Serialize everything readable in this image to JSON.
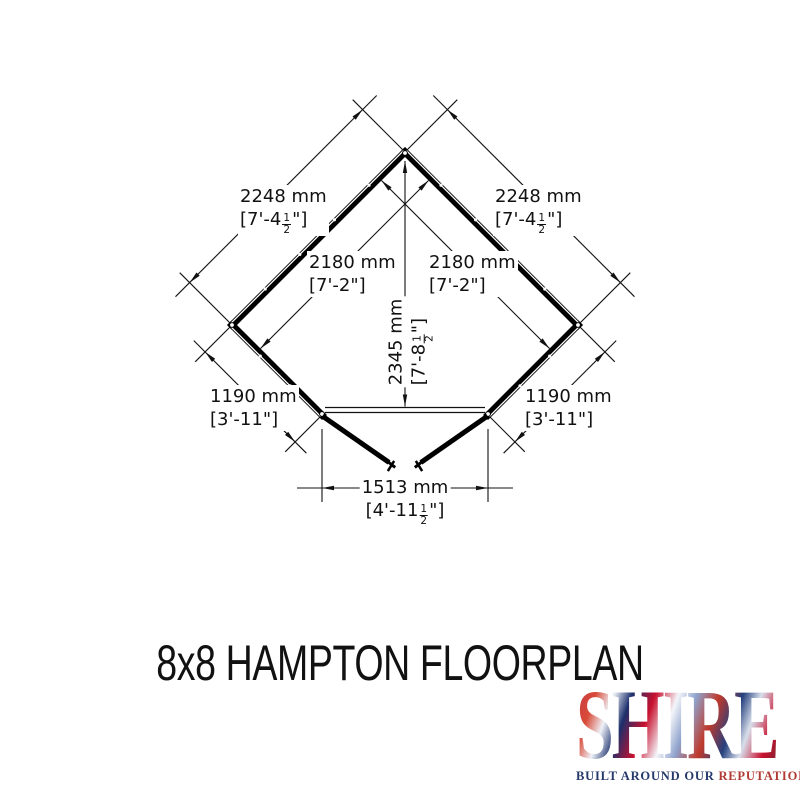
{
  "title": "8x8 HAMPTON FLOORPLAN",
  "floorplan": {
    "description": "Corner summerhouse plan view with open double doors",
    "dims": {
      "left_2248": {
        "mm": "2248 mm",
        "pre": "[7'-4",
        "num": "1",
        "den": "2",
        "post": "\"]"
      },
      "right_2248": {
        "mm": "2248 mm",
        "pre": "[7'-4",
        "num": "1",
        "den": "2",
        "post": "\"]"
      },
      "left_2180": {
        "mm": "2180 mm",
        "ft": "[7'-2\"]"
      },
      "right_2180": {
        "mm": "2180 mm",
        "ft": "[7'-2\"]"
      },
      "height_2345": {
        "mm": "2345 mm",
        "pre": "[7'-8",
        "num": "1",
        "den": "2",
        "post": "\"]"
      },
      "left_1190": {
        "mm": "1190 mm",
        "ft": "[3'-11\"]"
      },
      "right_1190": {
        "mm": "1190 mm",
        "ft": "[3'-11\"]"
      },
      "door_1513": {
        "mm": "1513 mm",
        "pre": "[4'-11",
        "num": "1",
        "den": "2",
        "post": "\"]"
      }
    },
    "line_color": "#111111"
  },
  "logo": {
    "name": "SHIRE",
    "tagline_primary": "BUILT AROUND OUR ",
    "tagline_accent": "REPUTATION",
    "colors": {
      "navy": "#26396b",
      "red": "#b03a33",
      "flag_red": "#c8102e",
      "flag_blue": "#1c2f6b"
    }
  }
}
